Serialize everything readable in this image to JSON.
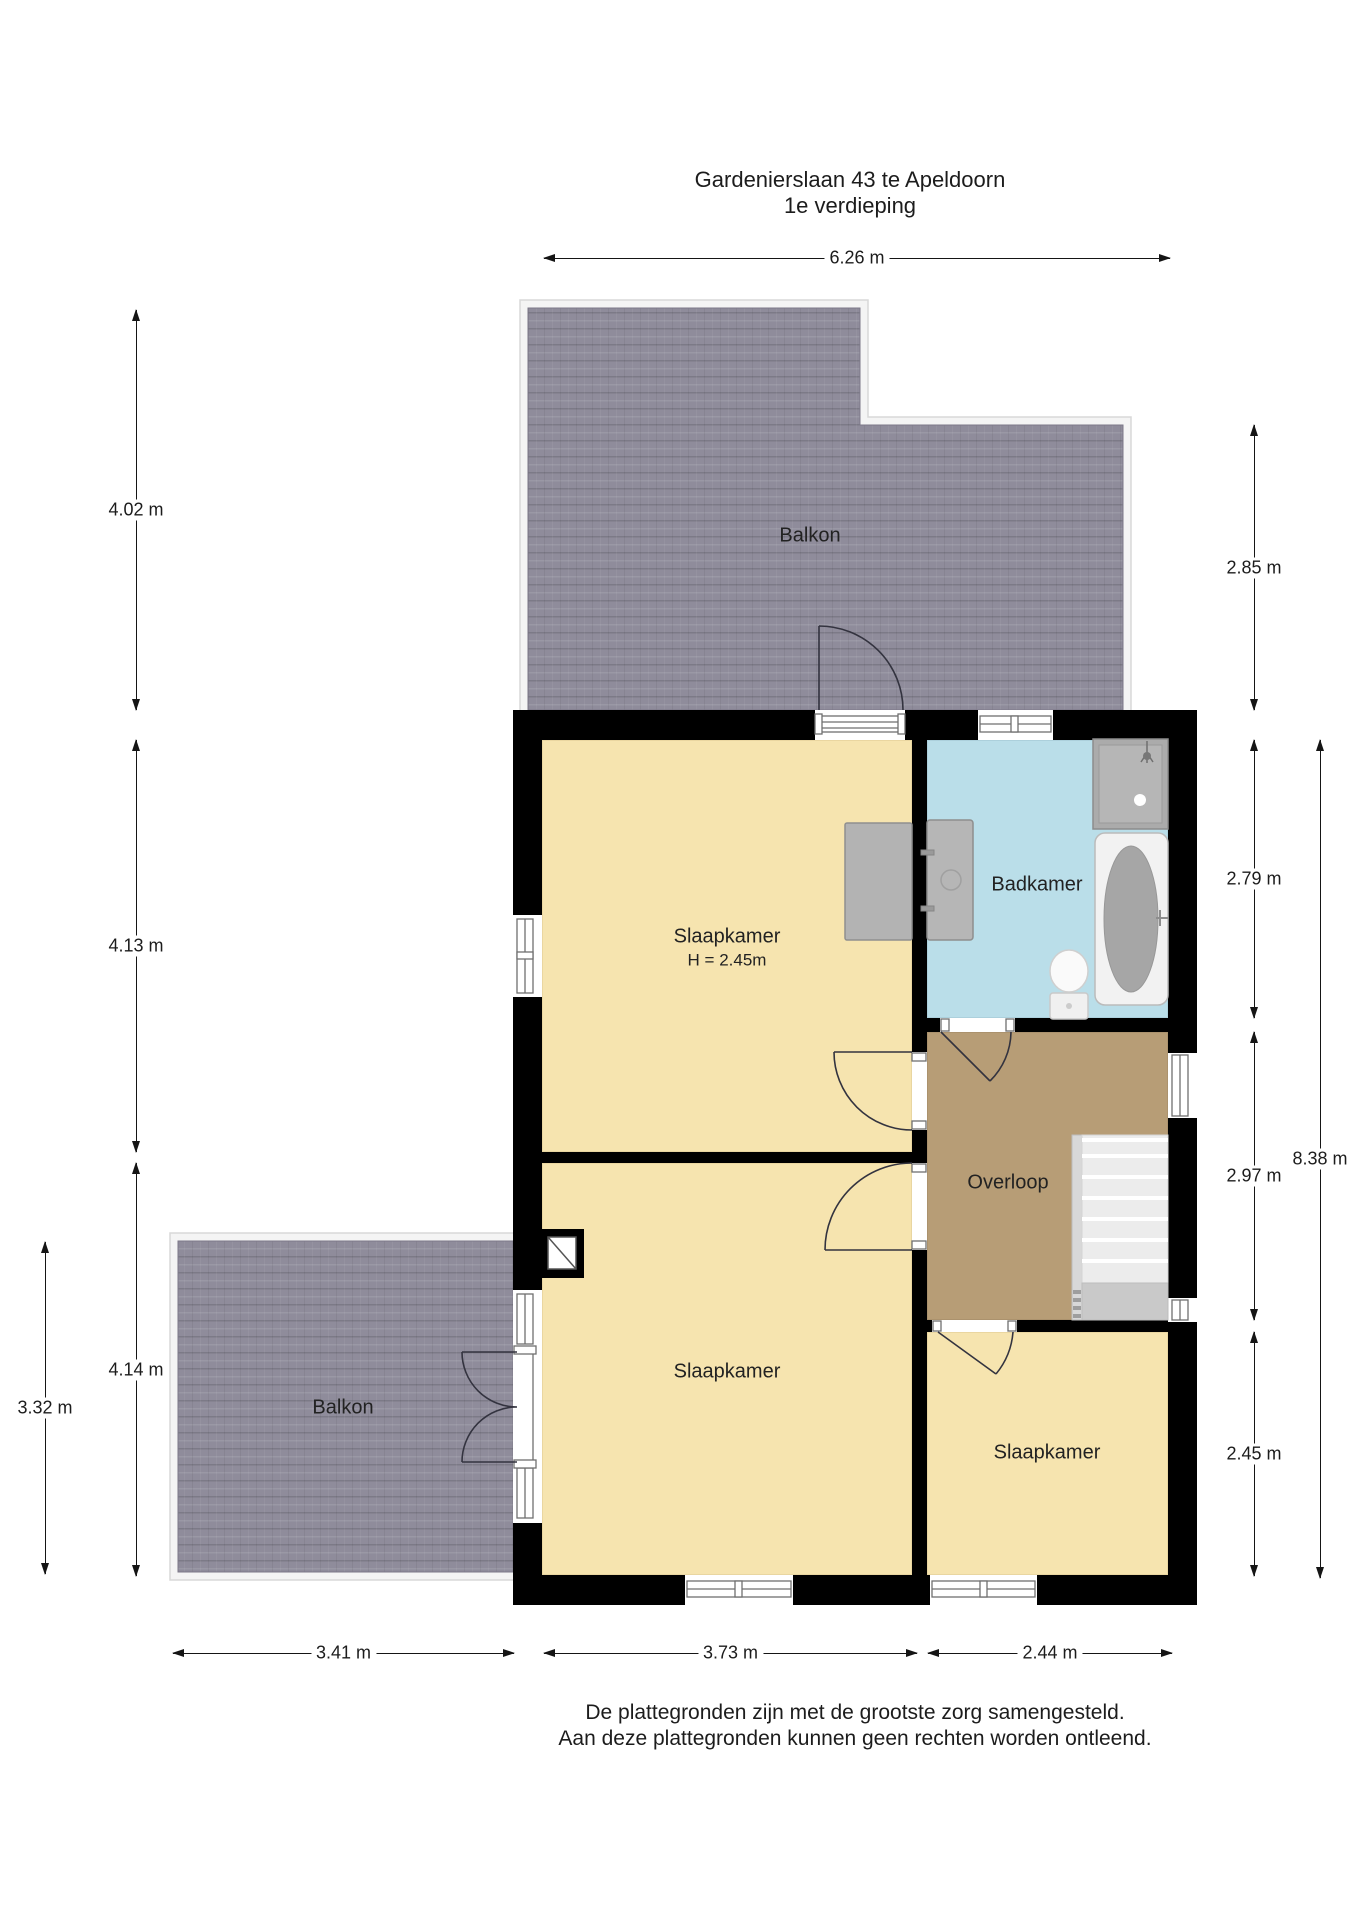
{
  "title": {
    "line1": "Gardenierslaan 43 te Apeldoorn",
    "line2": "1e verdieping"
  },
  "rooms": [
    {
      "id": "balkon-top",
      "label": "Balkon",
      "x": 810,
      "y": 536
    },
    {
      "id": "slaapkamer-1",
      "label": "Slaapkamer",
      "sub": "H = 2.45m",
      "x": 727,
      "y": 948
    },
    {
      "id": "badkamer",
      "label": "Badkamer",
      "x": 1037,
      "y": 885
    },
    {
      "id": "overloop",
      "label": "Overloop",
      "x": 1008,
      "y": 1183
    },
    {
      "id": "slaapkamer-2",
      "label": "Slaapkamer",
      "x": 727,
      "y": 1372
    },
    {
      "id": "slaapkamer-3",
      "label": "Slaapkamer",
      "x": 1047,
      "y": 1453
    },
    {
      "id": "balkon-bottom",
      "label": "Balkon",
      "x": 343,
      "y": 1408
    }
  ],
  "dimensions": [
    {
      "id": "top-626",
      "value": "6.26 m",
      "orient": "h",
      "y": 258,
      "x1": 544,
      "x2": 1170
    },
    {
      "id": "left-402",
      "value": "4.02 m",
      "orient": "v",
      "x": 136,
      "y1": 310,
      "y2": 710
    },
    {
      "id": "left-413",
      "value": "4.13 m",
      "orient": "v",
      "x": 136,
      "y1": 740,
      "y2": 1152
    },
    {
      "id": "left-414",
      "value": "4.14 m",
      "orient": "v",
      "x": 136,
      "y1": 1163,
      "y2": 1576
    },
    {
      "id": "left-332",
      "value": "3.32 m",
      "orient": "v",
      "x": 45,
      "y1": 1242,
      "y2": 1574
    },
    {
      "id": "right-285",
      "value": "2.85 m",
      "orient": "v",
      "x": 1254,
      "y1": 425,
      "y2": 710
    },
    {
      "id": "right-279",
      "value": "2.79 m",
      "orient": "v",
      "x": 1254,
      "y1": 740,
      "y2": 1018
    },
    {
      "id": "right-297",
      "value": "2.97 m",
      "orient": "v",
      "x": 1254,
      "y1": 1032,
      "y2": 1320
    },
    {
      "id": "right-245",
      "value": "2.45 m",
      "orient": "v",
      "x": 1254,
      "y1": 1332,
      "y2": 1576
    },
    {
      "id": "right-838",
      "value": "8.38 m",
      "orient": "v",
      "x": 1320,
      "y1": 740,
      "y2": 1578
    },
    {
      "id": "bottom-341",
      "value": "3.41 m",
      "orient": "h",
      "y": 1653,
      "x1": 173,
      "x2": 514
    },
    {
      "id": "bottom-373",
      "value": "3.73 m",
      "orient": "h",
      "y": 1653,
      "x1": 544,
      "x2": 917
    },
    {
      "id": "bottom-244",
      "value": "2.44 m",
      "orient": "h",
      "y": 1653,
      "x1": 928,
      "x2": 1172
    }
  ],
  "footer": {
    "line1": "De plattegronden zijn met de grootste zorg samengesteld.",
    "line2": "Aan deze plattegronden kunnen geen rechten worden ontleend."
  },
  "colors": {
    "wall": "#000000",
    "bedroom": "#f6e4af",
    "bathroom": "#badee9",
    "landing": "#b79d76",
    "balcony": "#8f8c9b",
    "text": "#1c1c1c"
  }
}
